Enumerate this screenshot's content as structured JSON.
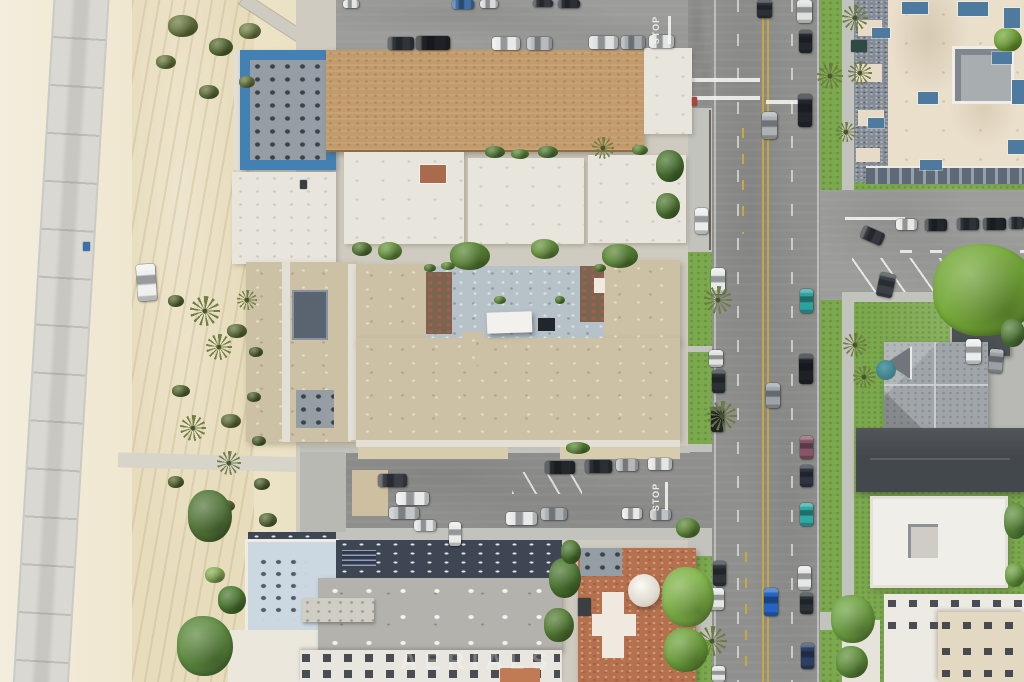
{
  "scene": {
    "type": "aerial-photo",
    "description": "Top-down drone photo of a beachfront city block: sand beach with bike path on the left, mid-rise apartment buildings with a U-shaped courtyard building in the center, a north-south boulevard with parked cars on the right, and houses with lawns on the far right."
  },
  "palette": {
    "sand": "#EDE5CC",
    "sand_tracks": "#E7DCBC",
    "bike_path": "#D9D8D2",
    "road": "#8F908E",
    "road_light": "#9C9C9A",
    "sidewalk": "#C3C3BD",
    "grass": "#7CA84E",
    "tree_green": "#6F9B3F",
    "tan_shingle_roof": "#C29B6D",
    "flat_tan_roof": "#CDC1A5",
    "white_roof": "#E8E5DD",
    "courtyard_deck": "#B6C1C8",
    "rooftop_deck_gray": "#969EA5",
    "rooftop_deck_lightblue": "#CBD8E2",
    "navy_roof": "#3E4654",
    "terracotta_roof": "#B5714E",
    "charcoal_roof": "#43484C",
    "victorian_roof": "#9FA5A8",
    "turret_teal": "#3E7B85",
    "complex_cream_roof": "#E9DFCB",
    "complex_shingle": "#868D96",
    "steel_blue_accent": "#4E7AA0",
    "blue_trim": "#4380B4",
    "yellow_line": "#C9A83C",
    "white_marking": "#F2F2EE"
  },
  "markings": {
    "stop_north": "STOP",
    "stop_south": "STOP"
  },
  "watermark": {
    "text": "AERIALS"
  },
  "vehicles": [
    [
      343,
      0,
      16,
      8,
      "#E4E6E5",
      0
    ],
    [
      452,
      0,
      22,
      9,
      "#3E6FA6",
      0
    ],
    [
      480,
      0,
      18,
      8,
      "#D8DBDA",
      0
    ],
    [
      533,
      0,
      20,
      7,
      "#34393F",
      0
    ],
    [
      558,
      0,
      22,
      8,
      "#2B3036",
      0
    ],
    [
      388,
      37,
      26,
      13,
      "#2F343A",
      0
    ],
    [
      416,
      36,
      34,
      14,
      "#1E2226",
      0
    ],
    [
      492,
      37,
      28,
      13,
      "#E8EAE9",
      0
    ],
    [
      527,
      37,
      25,
      13,
      "#B7BBBE",
      0
    ],
    [
      589,
      36,
      29,
      13,
      "#DEE1E0",
      0
    ],
    [
      621,
      36,
      24,
      13,
      "#A6ABAF",
      0
    ],
    [
      649,
      35,
      25,
      13,
      "#E3E5E4",
      0
    ],
    [
      545,
      461,
      30,
      13,
      "#24282C",
      0
    ],
    [
      585,
      460,
      27,
      13,
      "#2A2F34",
      0
    ],
    [
      616,
      459,
      22,
      12,
      "#B4B8BB",
      0
    ],
    [
      648,
      458,
      24,
      12,
      "#E4E6E5",
      0
    ],
    [
      378,
      474,
      29,
      13,
      "#3A3F45",
      0
    ],
    [
      396,
      492,
      33,
      13,
      "#E9EBEA",
      0
    ],
    [
      389,
      507,
      30,
      12,
      "#C2C6C9",
      0
    ],
    [
      414,
      520,
      22,
      11,
      "#DFE2E1",
      0
    ],
    [
      506,
      512,
      31,
      13,
      "#E8EAE9",
      0
    ],
    [
      541,
      508,
      26,
      12,
      "#ACB1B4",
      0
    ],
    [
      622,
      508,
      20,
      11,
      "#E7E9E8",
      0
    ],
    [
      650,
      509,
      21,
      11,
      "#BFC3C6",
      0
    ],
    [
      449,
      522,
      12,
      24,
      "#E9EBEA",
      0
    ],
    [
      695,
      208,
      13,
      26,
      "#EBEDEC",
      0
    ],
    [
      711,
      268,
      14,
      26,
      "#E7E9E8",
      0
    ],
    [
      709,
      350,
      14,
      17,
      "#DFE2E1",
      0
    ],
    [
      712,
      370,
      13,
      23,
      "#2B3035",
      0
    ],
    [
      711,
      407,
      13,
      25,
      "#24282D",
      0
    ],
    [
      713,
      561,
      13,
      25,
      "#30353A",
      0
    ],
    [
      710,
      588,
      14,
      22,
      "#E5E7E6",
      0
    ],
    [
      712,
      666,
      13,
      16,
      "#E2E4E3",
      0
    ],
    [
      797,
      0,
      15,
      23,
      "#DFE1E0",
      0
    ],
    [
      799,
      30,
      13,
      23,
      "#24282D",
      0
    ],
    [
      798,
      94,
      14,
      33,
      "#22262B",
      0
    ],
    [
      800,
      289,
      13,
      24,
      "#2BA49F",
      0
    ],
    [
      799,
      354,
      14,
      30,
      "#1E2226",
      0
    ],
    [
      800,
      436,
      13,
      23,
      "#8A5468",
      0
    ],
    [
      800,
      465,
      13,
      22,
      "#2E3440",
      0
    ],
    [
      800,
      503,
      13,
      23,
      "#2FA9A4",
      0
    ],
    [
      798,
      566,
      13,
      24,
      "#E6E8E7",
      0
    ],
    [
      800,
      593,
      13,
      21,
      "#2C3136",
      0
    ],
    [
      801,
      643,
      13,
      26,
      "#2B3F63",
      0
    ],
    [
      757,
      0,
      15,
      18,
      "#2C3035",
      0
    ],
    [
      762,
      112,
      15,
      27,
      "#ADB1B4",
      0
    ],
    [
      766,
      383,
      14,
      25,
      "#9EA3A7",
      0
    ],
    [
      764,
      588,
      14,
      28,
      "#2563C4",
      0
    ],
    [
      896,
      219,
      21,
      11,
      "#E6E8E7",
      0
    ],
    [
      925,
      219,
      22,
      12,
      "#24282C",
      0
    ],
    [
      957,
      218,
      22,
      12,
      "#2D3237",
      0
    ],
    [
      983,
      218,
      23,
      12,
      "#202428",
      0
    ],
    [
      1009,
      217,
      15,
      12,
      "#2F343A",
      0
    ],
    [
      861,
      229,
      23,
      13,
      "#33383E",
      24
    ],
    [
      878,
      273,
      16,
      24,
      "#3A4046",
      12
    ],
    [
      966,
      339,
      15,
      25,
      "#ECEEED",
      0
    ],
    [
      989,
      349,
      14,
      24,
      "#9BA0A4",
      5
    ],
    [
      137,
      264,
      19,
      37,
      "#EFF1F0",
      -4
    ]
  ],
  "objects": [
    [
      83,
      242,
      7,
      9,
      "#3A6FB0"
    ],
    [
      692,
      97,
      5,
      9,
      "#B04038"
    ],
    [
      851,
      40,
      16,
      12,
      "#2F4A42"
    ],
    [
      300,
      180,
      7,
      9,
      "#3A3F44"
    ],
    [
      578,
      598,
      13,
      18,
      "#3A3F44"
    ]
  ],
  "palm_trees": [
    [
      205,
      311,
      15
    ],
    [
      219,
      347,
      13
    ],
    [
      193,
      428,
      13
    ],
    [
      229,
      463,
      12
    ],
    [
      247,
      300,
      10
    ],
    [
      718,
      300,
      14
    ],
    [
      722,
      416,
      15
    ],
    [
      712,
      641,
      15
    ],
    [
      830,
      76,
      13
    ],
    [
      855,
      345,
      12
    ],
    [
      864,
      377,
      11
    ],
    [
      855,
      18,
      13
    ],
    [
      860,
      73,
      12
    ],
    [
      846,
      132,
      10
    ],
    [
      603,
      148,
      11
    ]
  ],
  "trees": [
    [
      985,
      290,
      52,
      46,
      "#74A838"
    ],
    [
      1008,
      40,
      14,
      12,
      "#74A838"
    ],
    [
      688,
      597,
      26,
      30,
      "#7FB347"
    ],
    [
      686,
      650,
      22,
      22,
      "#6FA33D"
    ],
    [
      565,
      578,
      16,
      20,
      "#4F7A33"
    ],
    [
      559,
      625,
      15,
      17,
      "#567F36"
    ],
    [
      571,
      552,
      10,
      12,
      "#507933"
    ],
    [
      470,
      256,
      20,
      14,
      "#5E8A38"
    ],
    [
      545,
      249,
      14,
      10,
      "#6B9840"
    ],
    [
      620,
      256,
      18,
      12,
      "#5E8A38"
    ],
    [
      390,
      251,
      12,
      9,
      "#6B9840"
    ],
    [
      362,
      249,
      10,
      7,
      "#587F36"
    ],
    [
      670,
      166,
      14,
      16,
      "#4D7733"
    ],
    [
      668,
      206,
      12,
      13,
      "#527C35"
    ],
    [
      688,
      528,
      12,
      10,
      "#5E8A38"
    ],
    [
      578,
      448,
      12,
      6,
      "#5E8A38"
    ],
    [
      1013,
      333,
      12,
      14,
      "#55803A"
    ],
    [
      1016,
      521,
      12,
      18,
      "#61913F"
    ],
    [
      853,
      619,
      22,
      24,
      "#6FA344"
    ],
    [
      852,
      662,
      16,
      16,
      "#62923C"
    ],
    [
      1015,
      575,
      10,
      12,
      "#6FA344"
    ],
    [
      495,
      152,
      10,
      6,
      "#57833B"
    ],
    [
      520,
      154,
      9,
      5,
      "#62923F"
    ],
    [
      548,
      152,
      10,
      6,
      "#57833B"
    ],
    [
      640,
      150,
      8,
      5,
      "#62923F"
    ],
    [
      183,
      26,
      15,
      11,
      "#6E7E42"
    ],
    [
      221,
      47,
      12,
      9,
      "#5C7038"
    ],
    [
      250,
      31,
      11,
      8,
      "#77874A"
    ],
    [
      166,
      62,
      10,
      7,
      "#6E7E42"
    ],
    [
      209,
      92,
      10,
      7,
      "#64753C"
    ],
    [
      247,
      82,
      8,
      6,
      "#6E7E42"
    ],
    [
      176,
      301,
      8,
      6,
      "#5C7038"
    ],
    [
      237,
      331,
      10,
      7,
      "#64753C"
    ],
    [
      181,
      391,
      9,
      6,
      "#5C7038"
    ],
    [
      231,
      421,
      10,
      7,
      "#64753C"
    ],
    [
      176,
      482,
      8,
      6,
      "#5C7038"
    ],
    [
      226,
      506,
      9,
      6,
      "#64753C"
    ],
    [
      256,
      352,
      7,
      5,
      "#57693A"
    ],
    [
      254,
      397,
      7,
      5,
      "#57693A"
    ],
    [
      259,
      441,
      7,
      5,
      "#57693A"
    ],
    [
      262,
      484,
      8,
      6,
      "#57693A"
    ],
    [
      268,
      520,
      9,
      7,
      "#5C7038"
    ],
    [
      210,
      516,
      22,
      26,
      "#55793A"
    ],
    [
      205,
      646,
      28,
      30,
      "#5D8A3F"
    ],
    [
      232,
      600,
      14,
      14,
      "#4F7A33"
    ],
    [
      215,
      575,
      10,
      8,
      "#8FB35B"
    ],
    [
      430,
      268,
      6,
      4,
      "#5E8A38"
    ],
    [
      448,
      266,
      7,
      4,
      "#6B9840"
    ],
    [
      500,
      300,
      6,
      4,
      "#6B9840"
    ],
    [
      560,
      300,
      5,
      4,
      "#5E8A38"
    ],
    [
      600,
      268,
      6,
      4,
      "#5E8A38"
    ]
  ],
  "complex_accents": [
    [
      872,
      28,
      18,
      10
    ],
    [
      902,
      2,
      26,
      12
    ],
    [
      958,
      2,
      30,
      14
    ],
    [
      1004,
      8,
      16,
      20
    ],
    [
      992,
      52,
      20,
      12
    ],
    [
      1012,
      80,
      12,
      24
    ],
    [
      918,
      92,
      20,
      12
    ],
    [
      868,
      118,
      16,
      10
    ],
    [
      1008,
      140,
      16,
      14
    ],
    [
      920,
      160,
      22,
      10
    ]
  ]
}
